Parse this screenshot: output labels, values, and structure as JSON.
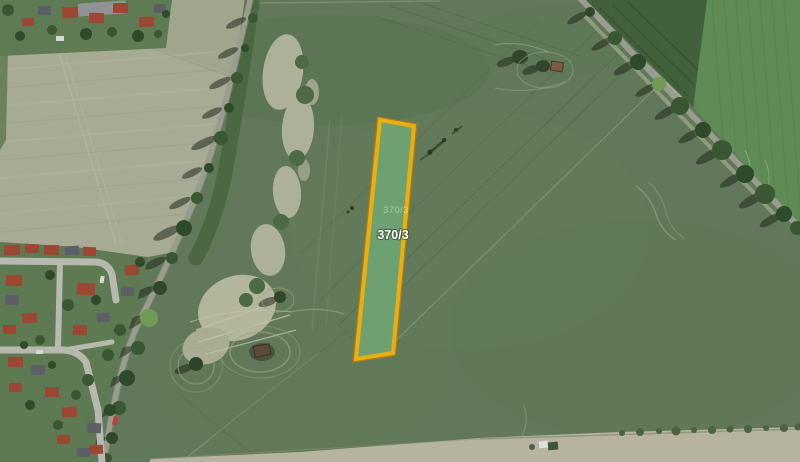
{
  "map": {
    "parcel": {
      "label": "370/3",
      "cadastral_label": "370/3",
      "outline_color": "#e9ae12",
      "outline_shadow_color": "#b97f08",
      "fill_color": "#6fa573",
      "label_color": "#ffffff"
    },
    "terrain_colors": {
      "main_field": "#61795a",
      "pale_field": "#a7ab94",
      "dark_field": "#41603b",
      "bright_field": "#5f8b55",
      "bare_soil": "#aeb199",
      "road": "#999c8e",
      "tree": "#3a5733",
      "roof_red": "#9a4733",
      "roof_gray": "#5c6066",
      "street": "#b7b9af"
    }
  }
}
